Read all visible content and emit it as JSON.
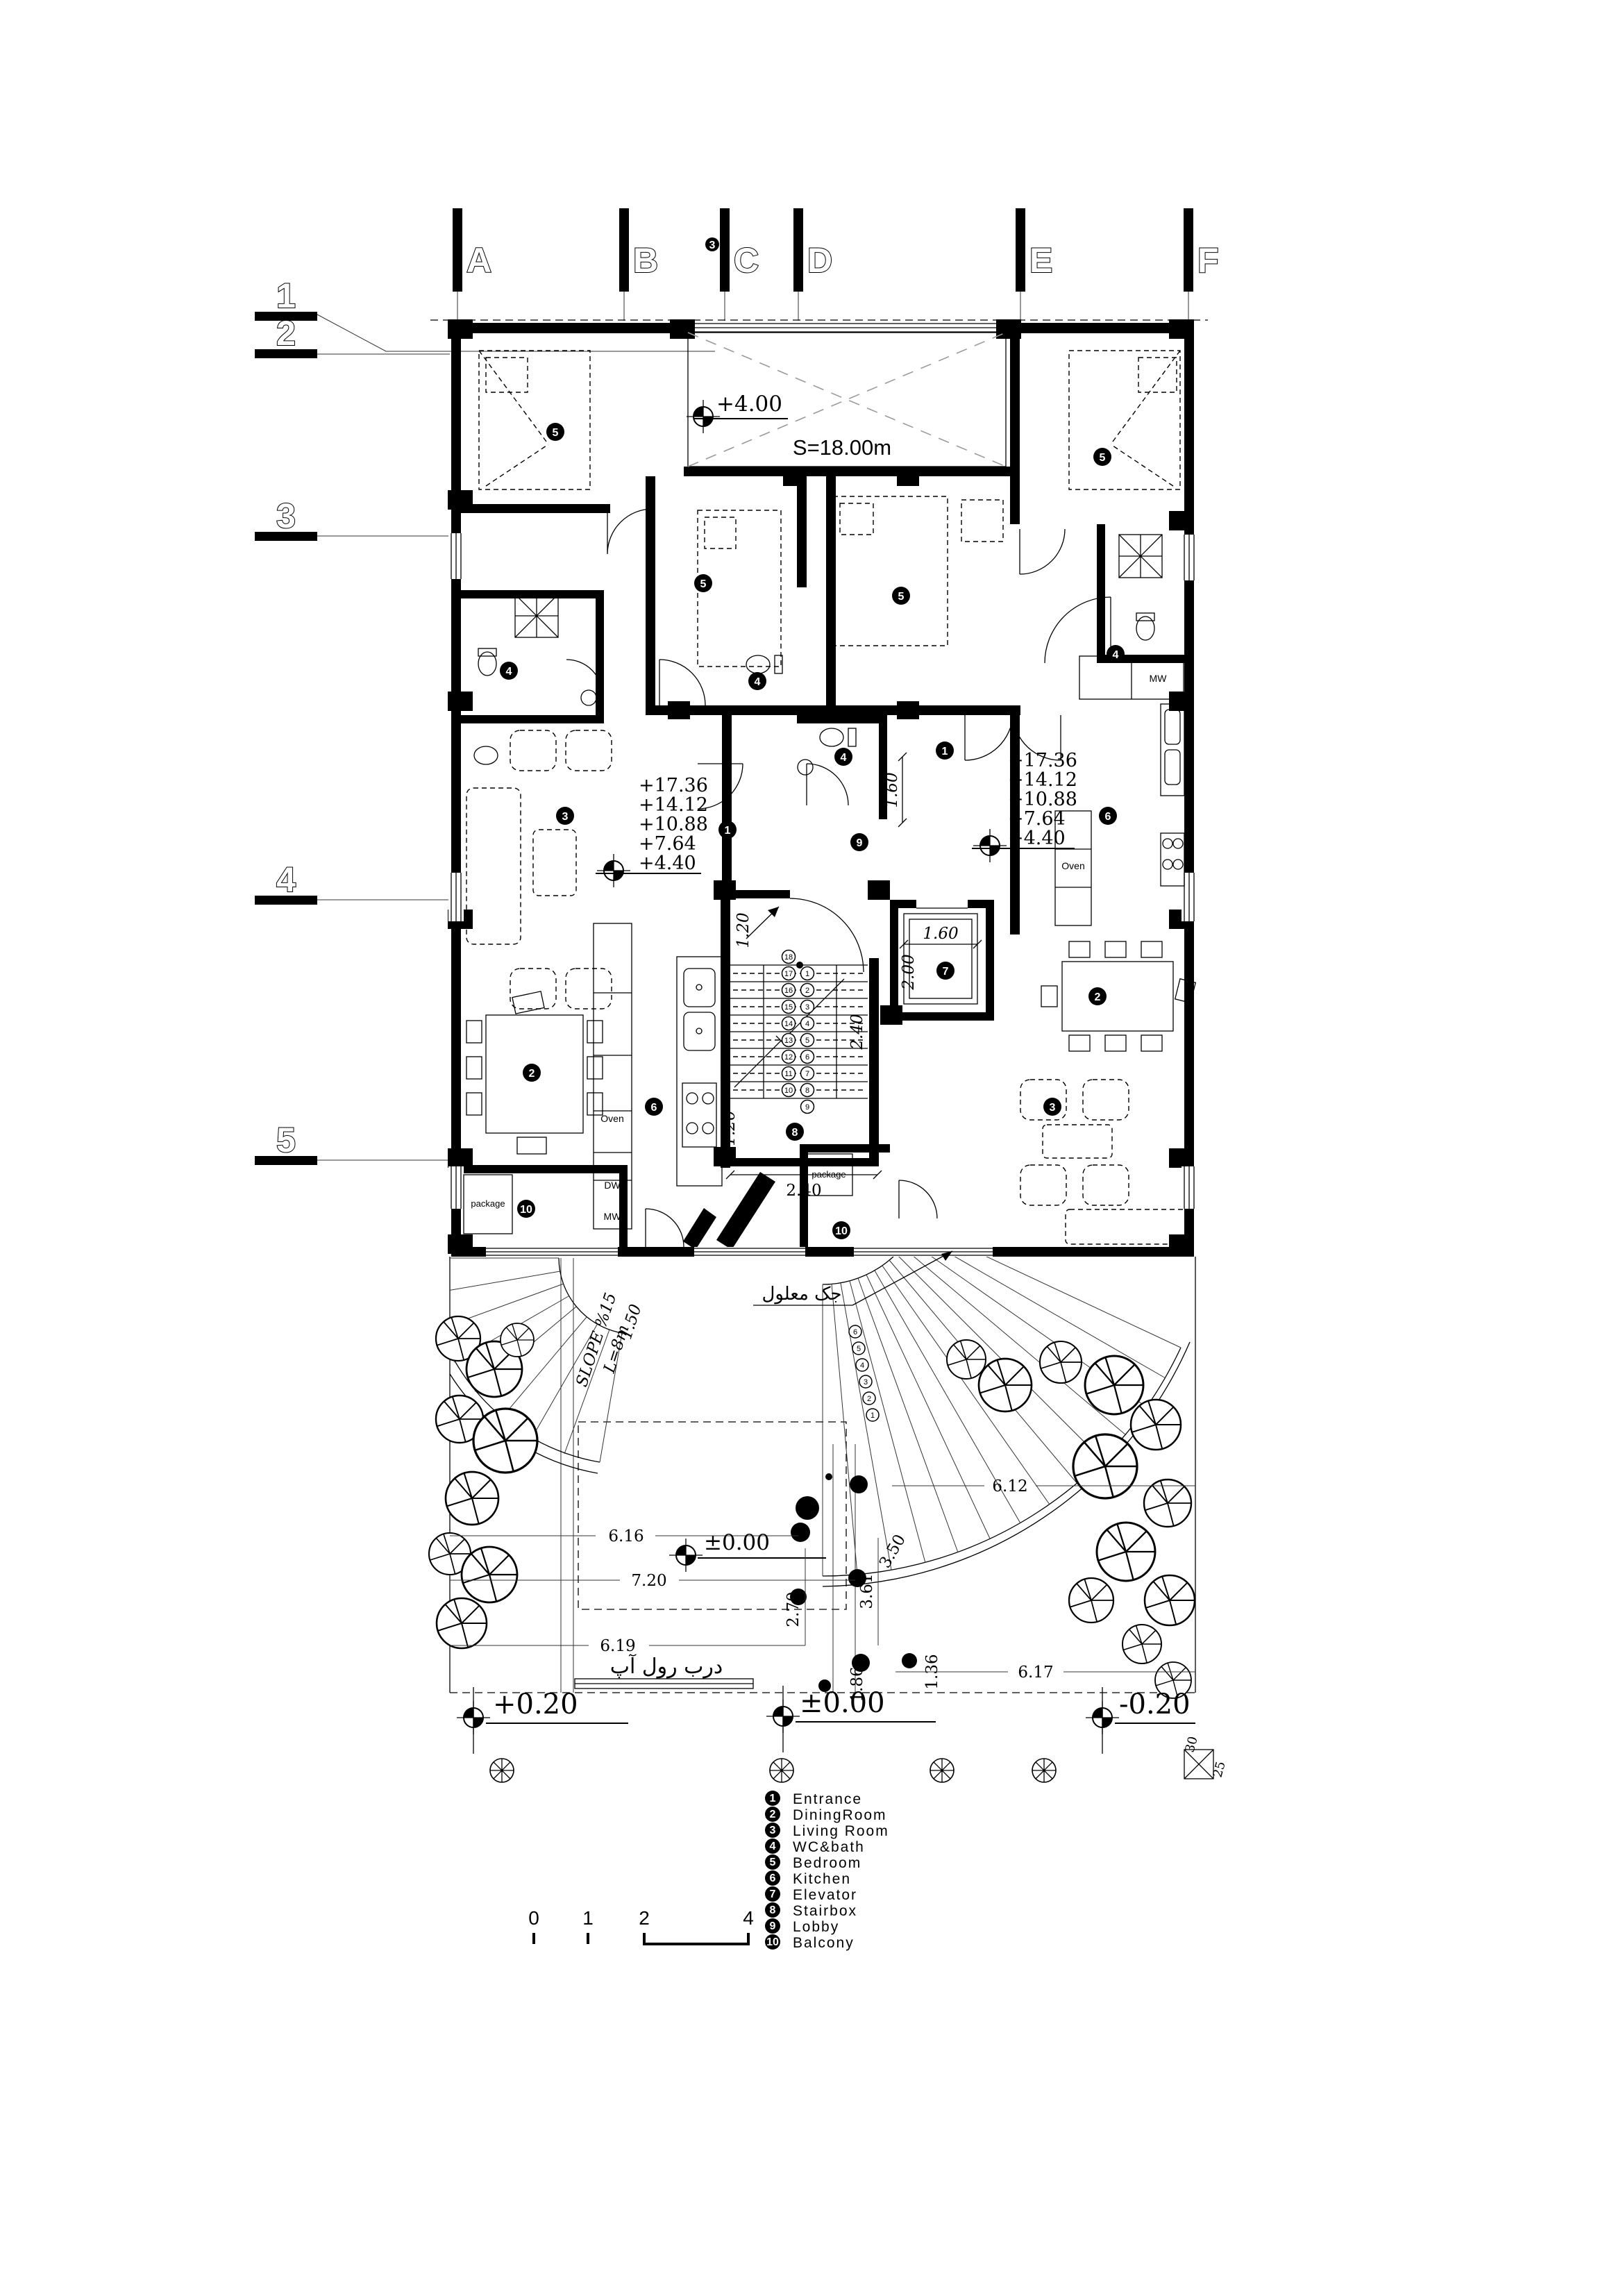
{
  "grid": {
    "cols": [
      "A",
      "B",
      "C",
      "D",
      "E",
      "F"
    ],
    "rows": [
      "1",
      "2",
      "3",
      "4",
      "5"
    ],
    "near_c_tag": "3"
  },
  "levels": {
    "void_mark": "+4.00",
    "void_area": "S=18.00m",
    "stack_left": [
      "+17.36",
      "+14.12",
      "+10.88",
      "+7.64",
      "+4.40"
    ],
    "stack_right": [
      "+17.36",
      "+14.12",
      "+10.88",
      "+7.64",
      "+4.40"
    ],
    "site_zero": "±0.00",
    "ground_left": "+0.20",
    "ground_center": "±0.00",
    "ground_right": "-0.20"
  },
  "dims": {
    "stair_top": "1.20",
    "stair_right": "2.40",
    "stair_bottom": "2.40",
    "stair_left": "1.20",
    "hall": "1.60",
    "elevator_w": "1.60",
    "elevator_d": "2.00",
    "site_a": "6.16",
    "site_b": "7.20",
    "site_c": "6.19",
    "site_d": "2.70",
    "site_e": "3.61",
    "site_f": "1.86",
    "site_g": "1.36",
    "site_h": "3.50",
    "site_i": "6.12",
    "site_j": "6.17",
    "site_k": "1.50"
  },
  "labels": {
    "oven": "Oven",
    "dw": "DW",
    "mw": "MW",
    "package": "package",
    "slope_a": "SLOPE %15",
    "slope_b": "L=8m",
    "rollup_door": "درب رول آپ",
    "handicap_jack": "جک معلول",
    "column_w": "30",
    "column_d": "25"
  },
  "tags": {
    "t1": "1",
    "t2": "2",
    "t3": "3",
    "t4": "4",
    "t5": "5",
    "t6": "6",
    "t7": "7",
    "t8": "8",
    "t9": "9",
    "t10": "10"
  },
  "stair": {
    "flight_down": [
      "18",
      "17",
      "16",
      "15",
      "14",
      "13",
      "12",
      "11",
      "10"
    ],
    "flight_up": [
      "1",
      "2",
      "3",
      "4",
      "5",
      "6",
      "7",
      "8",
      "9"
    ],
    "ramp_steps": [
      "6",
      "5",
      "4",
      "3",
      "2",
      "1"
    ]
  },
  "legend": {
    "items": [
      {
        "num": "1",
        "label": "Entrance"
      },
      {
        "num": "2",
        "label": "DiningRoom"
      },
      {
        "num": "3",
        "label": "Living Room"
      },
      {
        "num": "4",
        "label": "WC&bath"
      },
      {
        "num": "5",
        "label": "Bedroom"
      },
      {
        "num": "6",
        "label": "Kitchen"
      },
      {
        "num": "7",
        "label": "Elevator"
      },
      {
        "num": "8",
        "label": "Stairbox"
      },
      {
        "num": "9",
        "label": "Lobby"
      },
      {
        "num": "10",
        "label": "Balcony"
      }
    ]
  },
  "scalebar": {
    "t0": "0",
    "t1": "1",
    "t2": "2",
    "t4": "4"
  }
}
